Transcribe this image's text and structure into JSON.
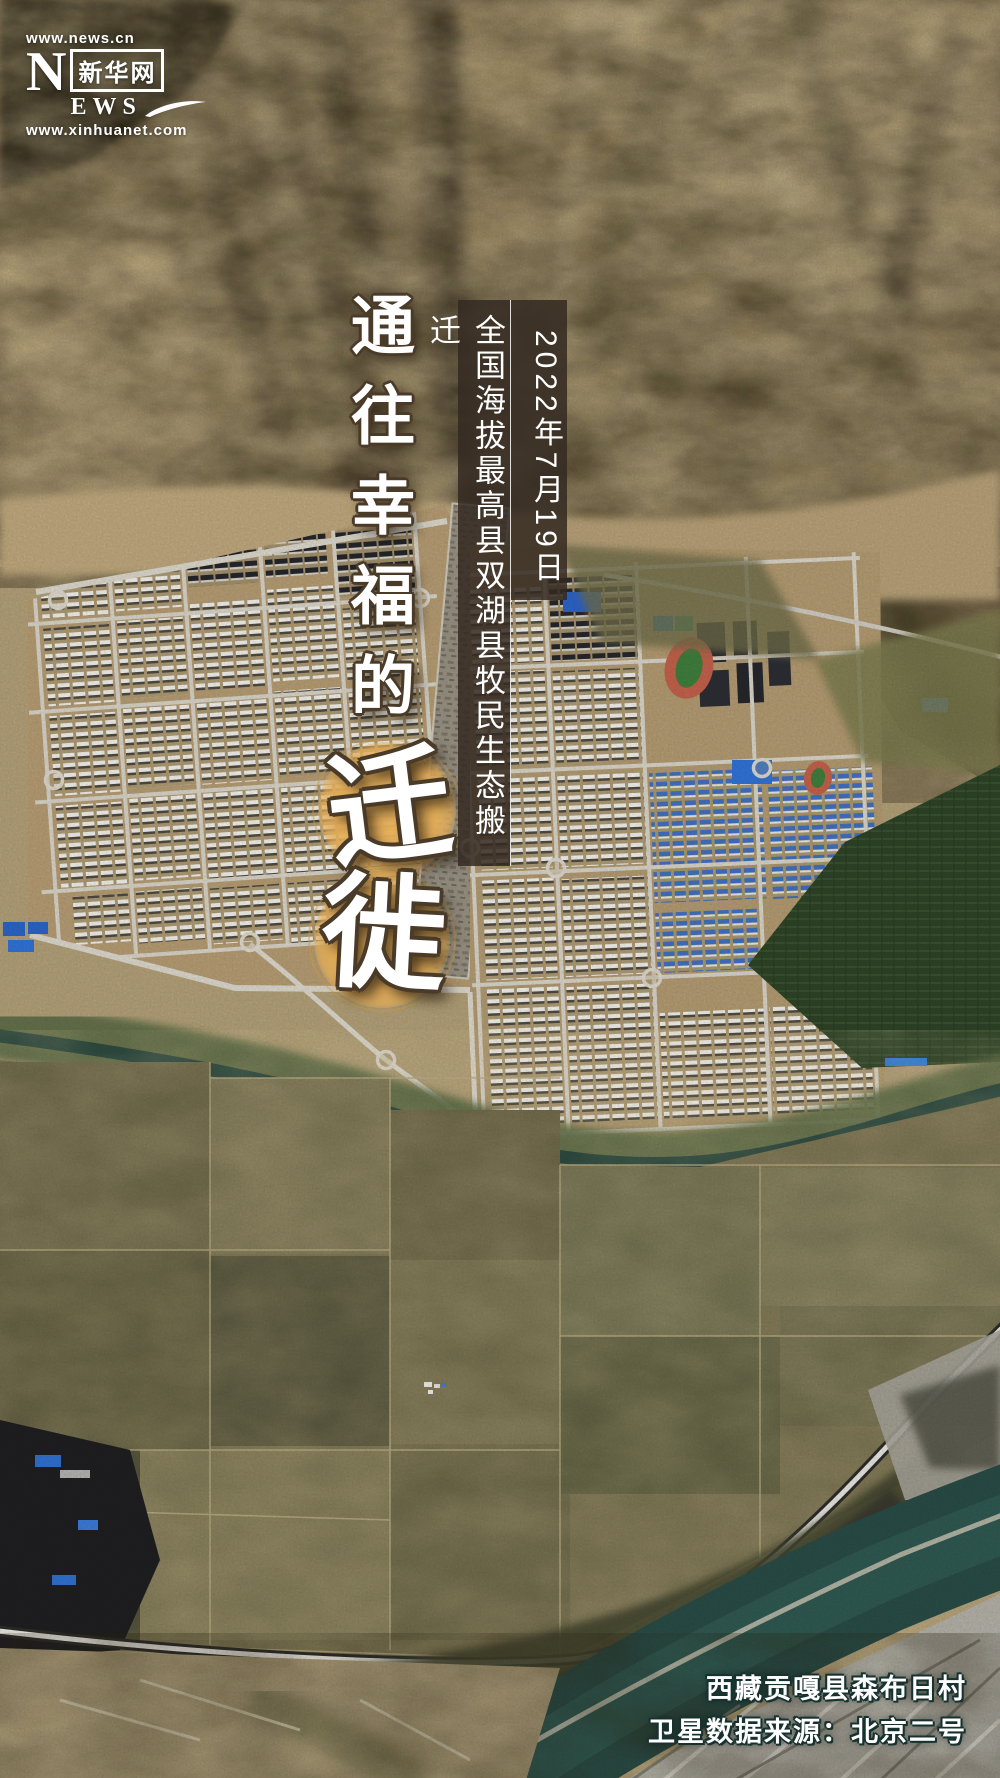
{
  "logo": {
    "top_url": "www.news.cn",
    "n_letter": "N",
    "ews_letters": "EWS",
    "brand": "新华网",
    "bottom_url": "www.xinhuanet.com"
  },
  "title": {
    "vertical_text": "通往幸福的",
    "char_qian": "迁",
    "char_xi": "徙"
  },
  "banner": {
    "date": "2022年7月19日",
    "info": "全国海拔最高县双湖县牧民生态搬迁"
  },
  "captions": {
    "location": "西藏贡嘎县森布日村",
    "source": "卫星数据来源：北京二号"
  },
  "colors": {
    "gold_accent": "#e6af58",
    "banner_background": "rgba(52,41,33,0.85)",
    "title_outline": "#4a3a28",
    "caption_outline": "#17322f",
    "river_teal": "#274a45"
  },
  "scene": {
    "type": "satellite-photo",
    "features": [
      "mountains",
      "relocation-village-grid",
      "stadium",
      "tree-plantation",
      "river",
      "farmland",
      "highway",
      "braided-river"
    ]
  }
}
